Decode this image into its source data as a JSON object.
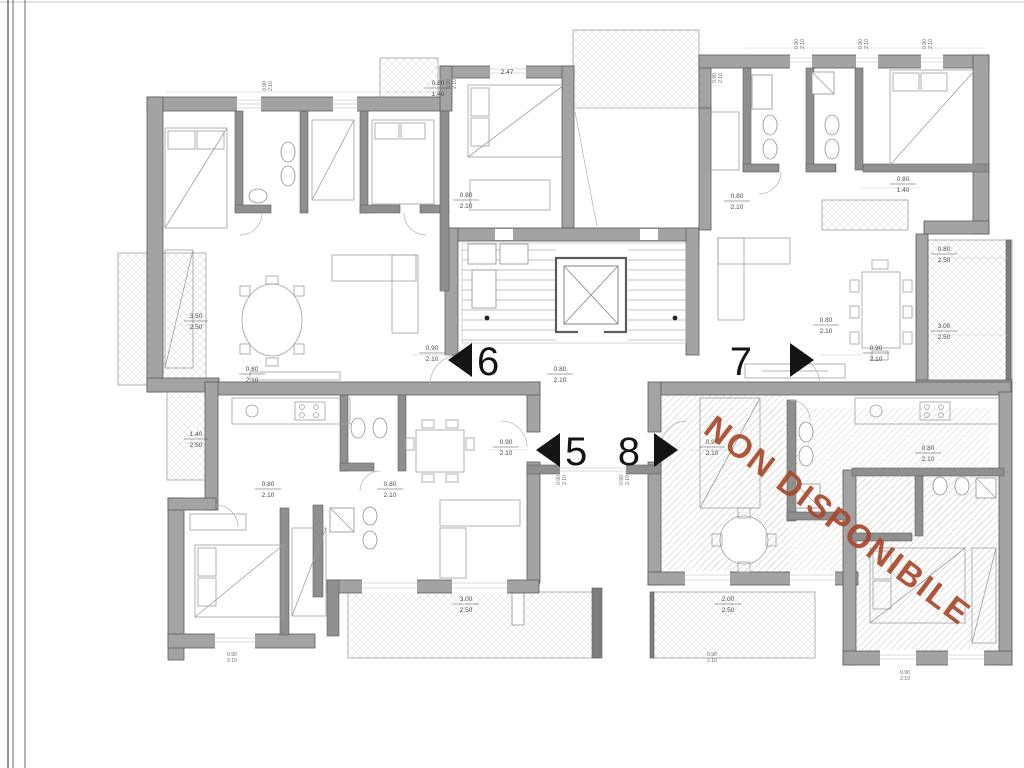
{
  "watermark": {
    "text": "NON DISPONIBILE",
    "color": "#a8492c"
  },
  "units": [
    {
      "label": "6",
      "arrow": "left"
    },
    {
      "label": "7",
      "arrow": "right"
    },
    {
      "label": "5",
      "arrow": "left"
    },
    {
      "label": "8",
      "arrow": "right"
    }
  ],
  "colors": {
    "wall": "#a3a3a3",
    "unit_number": "#141414",
    "dimension_text": "#4a4a4a"
  },
  "dims": [
    {
      "a": "0.90",
      "b": "2.10"
    },
    {
      "a": "0.90",
      "b": "2.10"
    },
    {
      "a": "0.90",
      "b": "2.10"
    },
    {
      "a": "0.90",
      "b": "2.10"
    },
    {
      "a": "3.50",
      "b": "2.50"
    },
    {
      "a": "1.40",
      "b": "2.50"
    },
    {
      "a": "3.00",
      "b": "2.50"
    },
    {
      "a": "2.00",
      "b": "2.50"
    },
    {
      "a": "0.80",
      "b": "2.50"
    },
    {
      "a": "3.00",
      "b": "2.50"
    },
    {
      "a": "0.80",
      "b": "1.40"
    },
    {
      "a": "0.80",
      "b": "1.40"
    },
    {
      "a": "2.47",
      "b": ""
    },
    {
      "a": "0.80",
      "b": "2.10"
    },
    {
      "a": "0.80",
      "b": "2.10"
    },
    {
      "a": "0.80",
      "b": "2.10"
    },
    {
      "a": "0.80",
      "b": "2.10"
    },
    {
      "a": "0.80",
      "b": "2.10"
    },
    {
      "a": "0.80",
      "b": "2.10"
    },
    {
      "a": "0.80",
      "b": "2.10"
    },
    {
      "a": "0.80",
      "b": "2.10"
    },
    {
      "a": "0.90",
      "b": "2.10"
    },
    {
      "a": "0.90",
      "b": "2.10"
    },
    {
      "a": "0.90",
      "b": "2.10"
    },
    {
      "a": "0.90",
      "b": "2.10"
    },
    {
      "a": "0.90",
      "b": "2.10"
    },
    {
      "a": "0.90",
      "b": "2.10"
    },
    {
      "a": "0.90",
      "b": "2.10"
    },
    {
      "a": "0.90",
      "b": "2.10"
    },
    {
      "a": "0.90",
      "b": "2.10"
    },
    {
      "a": "0.90",
      "b": "2.10"
    },
    {
      "a": "0.90",
      "b": "2.10"
    }
  ]
}
